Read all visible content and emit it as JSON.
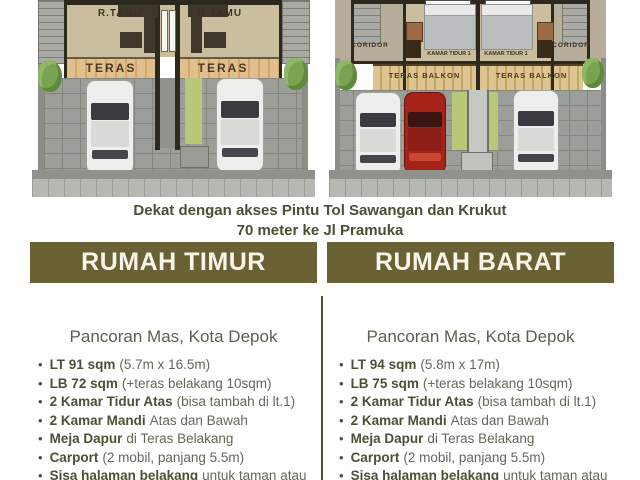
{
  "headline": {
    "line1": "Dekat dengan akses Pintu Tol Sawangan dan Krukut",
    "line2": "70 meter ke Jl Pramuka"
  },
  "floorplans": {
    "east": {
      "living_left": "R.TAMU",
      "living_right": "R.TAMU",
      "teras_left": "TERAS",
      "teras_right": "TERAS"
    },
    "west": {
      "coridor_left": "CORIDOR",
      "coridor_right": "CORIDOR",
      "bedroom_left": "KAMAR TIDUR 1",
      "bedroom_right": "KAMAR TIDUR 1",
      "teras_left": "TERAS BALKON",
      "teras_right": "TERAS BALKON"
    }
  },
  "houses": [
    {
      "title": "RUMAH TIMUR",
      "location": "Pancoran Mas, Kota Depok",
      "features": [
        {
          "bold": "LT 91 sqm",
          "rest": "(5.7m x 16.5m)"
        },
        {
          "bold": "LB 72 sqm",
          "rest": "(+teras belakang 10sqm)"
        },
        {
          "bold": "2 Kamar Tidur Atas",
          "rest": "(bisa tambah di lt.1)"
        },
        {
          "bold": "2 Kamar Mandi",
          "rest": "Atas dan Bawah"
        },
        {
          "bold": "Meja Dapur",
          "rest": "di Teras Belakang"
        },
        {
          "bold": "Carport",
          "rest": "(2 mobil, panjang 5.5m)"
        },
        {
          "bold": "Sisa halaman belakang",
          "rest": "untuk taman atau"
        }
      ]
    },
    {
      "title": "RUMAH BARAT",
      "location": "Pancoran Mas, Kota Depok",
      "features": [
        {
          "bold": "LT 94 sqm",
          "rest": "(5.8m x 17m)"
        },
        {
          "bold": "LB 75 sqm",
          "rest": "(+teras belakang 10sqm)"
        },
        {
          "bold": "2 Kamar Tidur Atas",
          "rest": "(bisa tambah di lt.1)"
        },
        {
          "bold": "2 Kamar Mandi",
          "rest": "Atas dan Bawah"
        },
        {
          "bold": "Meja Dapur",
          "rest": "di Teras Belakang"
        },
        {
          "bold": "Carport",
          "rest": "(2 mobil, panjang 5.5m)"
        },
        {
          "bold": "Sisa halaman belakang",
          "rest": "untuk taman atau"
        }
      ]
    }
  ],
  "colors": {
    "banner_bg": "#6a6134",
    "banner_text": "#f7f4ea",
    "headline_text": "#4b4f33",
    "feature_bold": "#4c5035",
    "feature_regular": "#646858",
    "divider": "#4d5136",
    "teras_strip": "#d5a869",
    "red_car": "#a62417",
    "bush_green": "#79a351"
  }
}
